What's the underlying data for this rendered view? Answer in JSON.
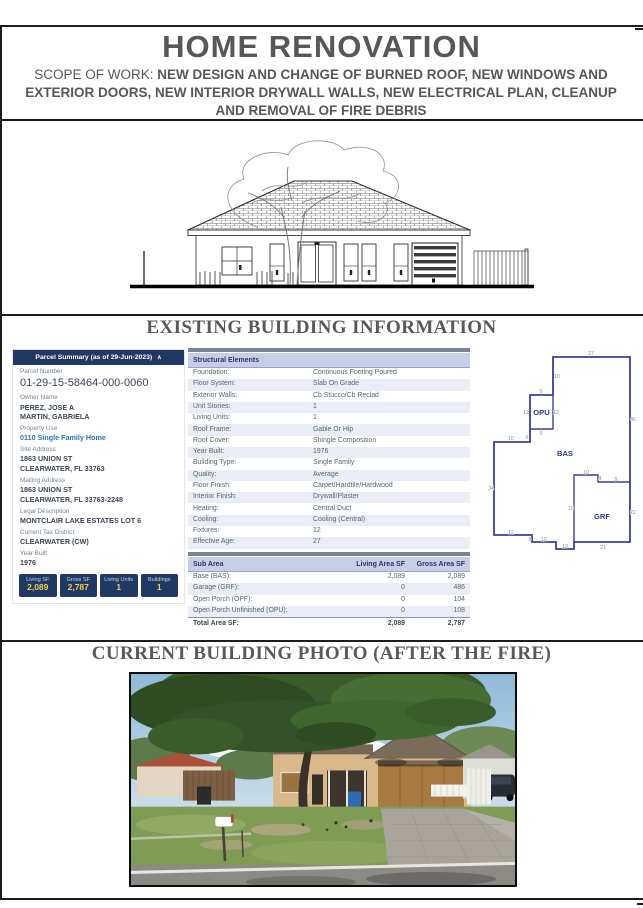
{
  "header": {
    "title": "HOME RENOVATION",
    "scope_label": "SCOPE OF WORK: ",
    "scope_text": " NEW DESIGN AND CHANGE OF BURNED ROOF, NEW WINDOWS AND EXTERIOR DOORS, NEW INTERIOR DRYWALL WALLS, NEW ELECTRICAL PLAN, CLEANUP AND REMOVAL OF FIRE DEBRIS"
  },
  "sections": {
    "existing_title": "EXISTING BUILDING INFORMATION",
    "photo_title": "CURRENT BUILDING PHOTO (AFTER THE FIRE)"
  },
  "parcel_summary": {
    "header": "Parcel Summary (as of 29-Jun-2023)",
    "collapse_icon": "∧",
    "fields": [
      {
        "label": "Parcel Number",
        "value": "01-29-15-58464-000-0060",
        "style": "big"
      },
      {
        "label": "Owner Name",
        "value": "PEREZ, JOSE A\nMARTIN, GABRIELA"
      },
      {
        "label": "Property Use",
        "value": "0110 Single Family Home",
        "style": "link"
      },
      {
        "label": "Site Address",
        "value": "1863 UNION ST\nCLEARWATER, FL 33763"
      },
      {
        "label": "Mailing Address",
        "value": "1863 UNION ST\nCLEARWATER, FL 33763-2248"
      },
      {
        "label": "Legal Description",
        "value": "MONTCLAIR LAKE ESTATES LOT 6"
      },
      {
        "label": "Current Tax District",
        "value": "CLEARWATER (CW)"
      },
      {
        "label": "Year Built",
        "value": "1976"
      }
    ],
    "stats": [
      {
        "label": "Living SF",
        "value": "2,089"
      },
      {
        "label": "Gross SF",
        "value": "2,787"
      },
      {
        "label": "Living Units",
        "value": "1"
      },
      {
        "label": "Buildings",
        "value": "1"
      }
    ]
  },
  "structural_elements": {
    "header": "Structural Elements",
    "rows": [
      {
        "label": "Foundation:",
        "value": "Continuous Footing Poured"
      },
      {
        "label": "Floor System:",
        "value": "Slab On Grade"
      },
      {
        "label": "Exterior Walls:",
        "value": "Cb Stucco/Cb Reclad"
      },
      {
        "label": "Unit Stories:",
        "value": "1"
      },
      {
        "label": "Living Units:",
        "value": "1"
      },
      {
        "label": "Roof Frame:",
        "value": "Gable Or Hip"
      },
      {
        "label": "Roof Cover:",
        "value": "Shingle Composition"
      },
      {
        "label": "Year Built:",
        "value": "1976"
      },
      {
        "label": "Building Type:",
        "value": "Single Family"
      },
      {
        "label": "Quality:",
        "value": "Average"
      },
      {
        "label": "Floor Finish:",
        "value": "Carpet/Hardtile/Hardwood"
      },
      {
        "label": "Interior Finish:",
        "value": "Drywall/Plaster"
      },
      {
        "label": "Heating:",
        "value": "Central Duct"
      },
      {
        "label": "Cooling:",
        "value": "Cooling (Central)"
      },
      {
        "label": "Fixtures:",
        "value": "12"
      },
      {
        "label": "Effective Age:",
        "value": "27"
      }
    ]
  },
  "sub_area": {
    "headers": [
      "Sub Area",
      "Living Area SF",
      "Gross Area SF"
    ],
    "rows": [
      [
        "Base (BAS):",
        "2,089",
        "2,089"
      ],
      [
        "Garage (GRF):",
        "0",
        "486"
      ],
      [
        "Open Porch (OPF):",
        "0",
        "104"
      ],
      [
        "Open Porch Unfinished (OPU):",
        "0",
        "108"
      ]
    ],
    "total": [
      "Total Area SF:",
      "2,089",
      "2,787"
    ]
  },
  "floor_plan": {
    "areas": [
      "OPU",
      "BAS",
      "GRF"
    ],
    "dims": [
      "27",
      "10",
      "9",
      "12",
      "12",
      "9",
      "6",
      "10",
      "34",
      "12",
      "8",
      "10",
      "13",
      "16",
      "10",
      "4",
      "9",
      "46",
      "22",
      "21"
    ]
  },
  "colors": {
    "heading_gray": "#595959",
    "navy_header": "#1F3864",
    "lavender_header": "#C9CEE8",
    "alt_row": "#EBEDF6",
    "slate_bar": "#7B8494",
    "stat_value_yellow": "#F7CF4A",
    "link_blue": "#2E74B5",
    "plan_line_navy": "#3C3F99"
  }
}
